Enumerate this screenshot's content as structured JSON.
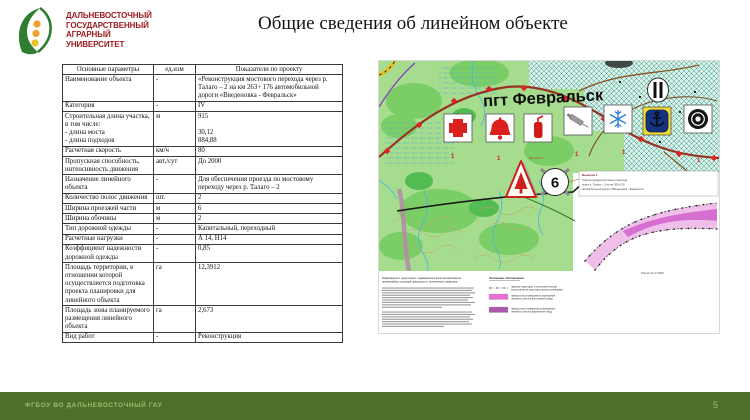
{
  "slide": {
    "title": "Общие сведения об линейном объекте",
    "footer": "ФГБОУ ВО ДАЛЬНЕВОСТОЧНЫЙ ГАУ",
    "page_number": "5"
  },
  "logo": {
    "lines": [
      "ДАЛЬНЕВОСТОЧНЫЙ",
      "ГОСУДАРСТВЕННЫЙ",
      "АГРАРНЫЙ",
      "УНИВЕРСИТЕТ"
    ]
  },
  "table": {
    "headers": [
      "Основные параметры",
      "ед.изм",
      "Показатели по проекту"
    ],
    "rows": [
      [
        "Наименование объекта",
        "-",
        "«Реконструкция мостового перехода через р. Талаго – 2 на км 263+ 176 автомобильной дороги «Введеновка - Февральск»"
      ],
      [
        "Категория",
        "-",
        "IV"
      ],
      [
        "Строительная длина участка, в том числе:\n- длина моста\n- длина подходов",
        "м",
        "915\n\n30,12\n884,88"
      ],
      [
        "Расчетная скорость",
        "км/ч",
        "80"
      ],
      [
        "Пропускная способность, интенсивность движения",
        "авт./сут",
        "До 2000"
      ],
      [
        "Назначение линейного объекта",
        "-",
        "Для обеспечения проезда по мостовому переходу через р. Талаго – 2"
      ],
      [
        "Количество полос движения",
        "шт.",
        "2"
      ],
      [
        "Ширина проезжей части",
        "м",
        "6"
      ],
      [
        "Ширина обочины",
        "м",
        "2"
      ],
      [
        "Тип дорожной одежды",
        "-",
        "Капитальный, переходный"
      ],
      [
        "Расчетные нагрузки",
        "-",
        "А 14, Н14"
      ],
      [
        "Коэффициент надежности дорожной одежды",
        "-",
        "0,85"
      ],
      [
        "Площадь территории, в отношении которой осуществляется подготовка проекта планировки для линейного объекта",
        "га",
        "12,3912"
      ],
      [
        "Площадь зоны планируемого размещения линейного объекта",
        "га",
        "2,673"
      ],
      [
        "Вид работ",
        "-",
        "Реконструкция"
      ]
    ]
  },
  "map": {
    "town_label": "пгт Февральск",
    "km_marker": "6",
    "road_marker": "1",
    "callout_ref": "Выноска 1",
    "callout_lines": [
      "Выноска 1",
      "\"Реконструкция мостового перехода",
      "через р. Талаго – 2 на км 263+176",
      "автомобильной дороги \"Введеновка - Февральск\""
    ],
    "scale_text": "Масштаб 1:5000",
    "notes_heading_lines": [
      "Информация о территориях, подверженных риску возникновения",
      "чрезвычайных ситуаций природного и техногенного характера"
    ],
    "legend": {
      "title": "Условные обозначения",
      "items": [
        {
          "symbol": "dash-dot-line",
          "color": "#666666",
          "lines": [
            "границы территории, в отношении которой",
            "осуществляется подготовка проекта планировки"
          ]
        },
        {
          "symbol": "swatch",
          "color": "#e96fd8",
          "lines": [
            "граница зоны планируемого размещения",
            "линейного объекта (постоянный отвод)"
          ]
        },
        {
          "symbol": "swatch",
          "color": "#a959ad",
          "lines": [
            "граница зоны планируемого размещения",
            "линейного объекта (временный отвод)"
          ]
        }
      ]
    },
    "icons": [
      "red-cross",
      "bell",
      "fire-extinguisher",
      "syringe",
      "snowflake",
      "anchor",
      "police-badge",
      "factory",
      "tree-warning"
    ]
  },
  "colors": {
    "footer_bg": "#4c7029",
    "footer_text": "#9cb96b",
    "logo_text": "#9c1c20",
    "map_green": "#a5dc8e",
    "corridor_fill": "#f0bfe9",
    "corridor_stripe": "#d66fd0"
  }
}
